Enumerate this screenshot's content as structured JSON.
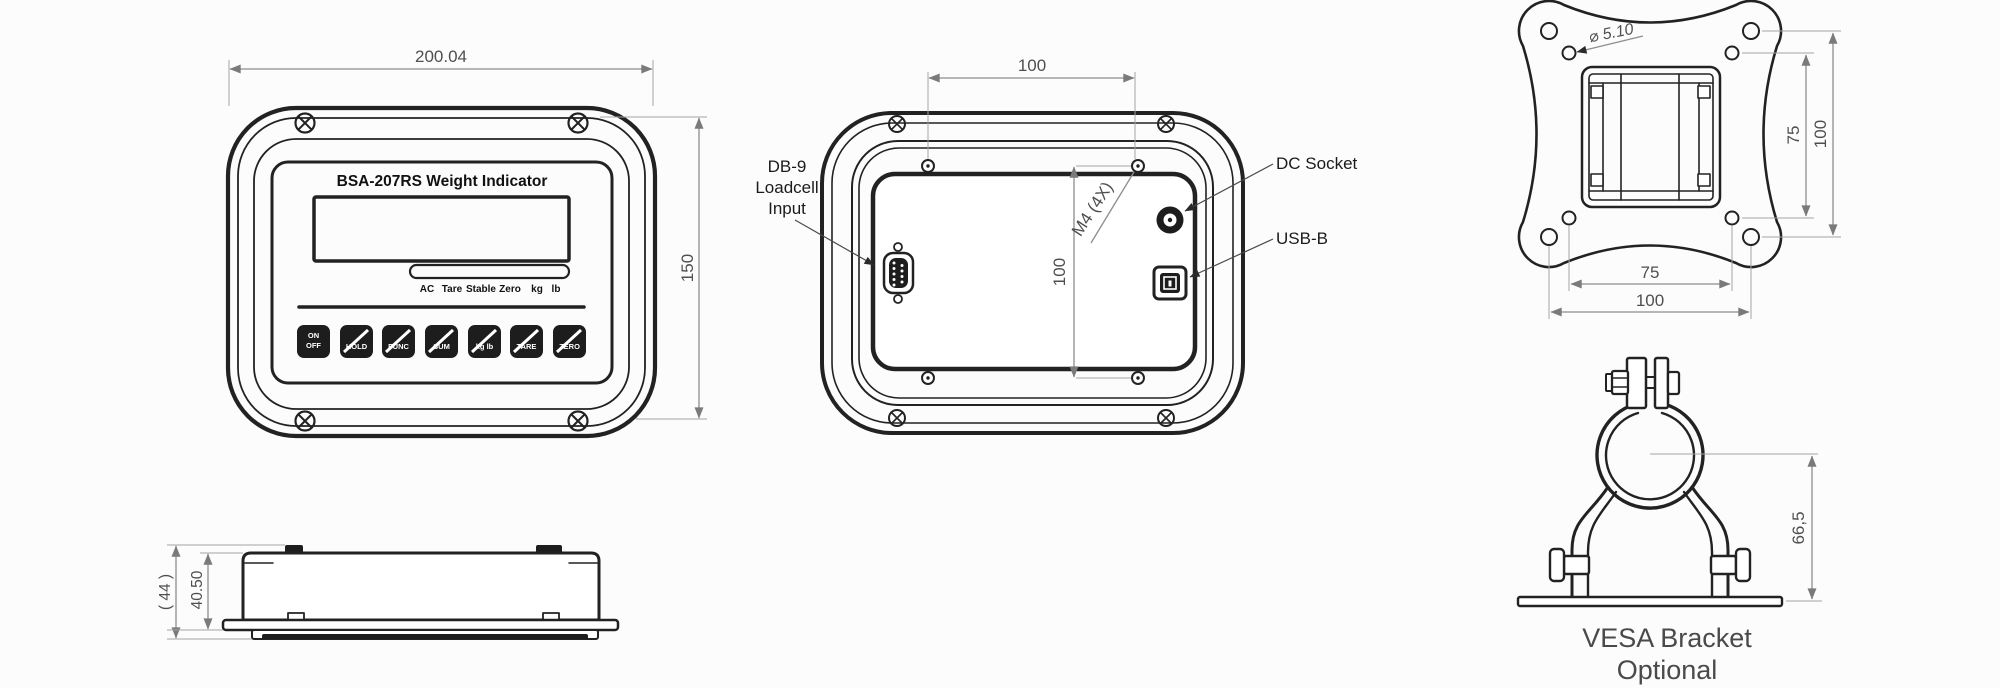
{
  "colors": {
    "line": "#222222",
    "dimension_line": "#8d8d8d",
    "dimension_text": "#4f4f4f",
    "label_text": "#1b1b1b",
    "button_fill": "#1d1d1d",
    "background": "#fcfcfc"
  },
  "front_view": {
    "title": "BSA-207RS Weight Indicator",
    "dim_width": "200.04",
    "dim_height": "150",
    "status_labels": [
      "AC",
      "Tare",
      "Stable",
      "Zero",
      "kg",
      "lb"
    ],
    "buttons": [
      {
        "line1": "ON",
        "line2": "OFF"
      },
      {
        "line1": "HOLD"
      },
      {
        "line1": "FUNC"
      },
      {
        "line1": "SUM"
      },
      {
        "line1": "kg lb"
      },
      {
        "line1": "TARE"
      },
      {
        "line1": "ZERO"
      }
    ]
  },
  "side_view": {
    "dim_total_height": "( 44 )",
    "dim_body_height": "40.50"
  },
  "rear_view": {
    "dim_hole_spacing_horizontal": "100",
    "dim_hole_spacing_vertical": "100",
    "thread_callout": "M4 (4X)",
    "db9_label_line1": "DB-9",
    "db9_label_line2": "Loadcell",
    "db9_label_line3": "Input",
    "dc_socket_label": "DC Socket",
    "usb_label": "USB-B"
  },
  "vesa_plate": {
    "hole_diameter_callout": "⌀ 5.10",
    "dim_inner_vertical": "75",
    "dim_outer_vertical": "100",
    "dim_inner_horizontal": "75",
    "dim_outer_horizontal": "100"
  },
  "vesa_bracket": {
    "dim_height": "66,5",
    "caption_line1": "VESA  Bracket",
    "caption_line2": "Optional"
  }
}
